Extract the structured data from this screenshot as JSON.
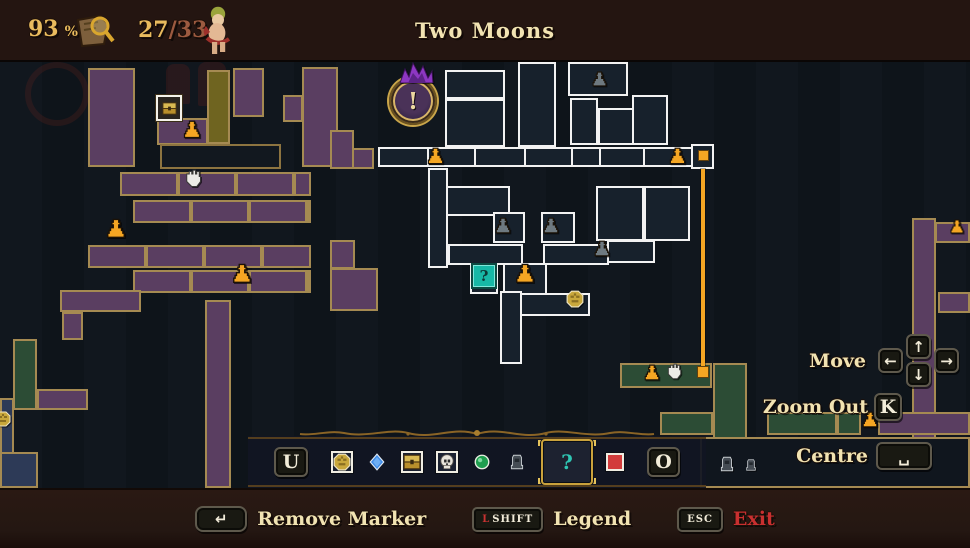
{
  "header": {
    "completion_value": "93",
    "completion_unit": "%",
    "collect_current": "27",
    "collect_rest": "/33",
    "title": "Two Moons"
  },
  "controls": {
    "move": {
      "label": "Move",
      "keys": {
        "left": "←",
        "up": "↑",
        "down": "↓",
        "right": "→"
      }
    },
    "zoom_out": {
      "label": "Zoom Out",
      "key": "K"
    },
    "centre": {
      "label": "Centre",
      "key_glyph": "␣"
    }
  },
  "marker_bar": {
    "left_key": "U",
    "right_key": "O",
    "selected_index": 6,
    "markers": [
      {
        "name": "gold-seal"
      },
      {
        "name": "blue-diamond"
      },
      {
        "name": "chest"
      },
      {
        "name": "skull"
      },
      {
        "name": "green-gem"
      },
      {
        "name": "tombstone"
      },
      {
        "name": "question-mark",
        "glyph": "?"
      },
      {
        "name": "red-square"
      }
    ]
  },
  "footer": {
    "remove_marker_key_glyph": "↵",
    "remove_marker_label": "Remove Marker",
    "legend_key_prefix": "L",
    "legend_key_text": "SHIFT",
    "legend_label": "Legend",
    "exit_key": "ESC",
    "exit_label": "Exit"
  },
  "map": {
    "player_marker": {
      "x": 389,
      "y": 17,
      "size": 44,
      "glyph": "!"
    },
    "question_marker_glyph": "?",
    "elevator": {
      "x": 701,
      "y": 109,
      "h": 199
    },
    "rooms": [
      [
        88,
        8,
        47,
        99,
        "P"
      ],
      [
        157,
        58,
        51,
        27,
        "P"
      ],
      [
        233,
        8,
        31,
        49,
        "P"
      ],
      [
        302,
        7,
        36,
        100,
        "P"
      ],
      [
        283,
        35,
        20,
        27,
        "P"
      ],
      [
        352,
        88,
        22,
        21,
        "P"
      ],
      [
        330,
        70,
        24,
        39,
        "P"
      ],
      [
        120,
        112,
        191,
        24,
        "P",
        "seg"
      ],
      [
        133,
        140,
        178,
        23,
        "P",
        "seg"
      ],
      [
        88,
        185,
        223,
        23,
        "P",
        "seg"
      ],
      [
        133,
        210,
        178,
        23,
        "P",
        "seg"
      ],
      [
        60,
        230,
        81,
        22,
        "P"
      ],
      [
        62,
        252,
        21,
        28,
        "P"
      ],
      [
        330,
        180,
        25,
        29,
        "P"
      ],
      [
        330,
        208,
        48,
        43,
        "P"
      ],
      [
        37,
        329,
        51,
        21,
        "P"
      ],
      [
        205,
        240,
        26,
        188,
        "P"
      ],
      [
        912,
        158,
        24,
        240,
        "P"
      ],
      [
        935,
        162,
        35,
        21,
        "P"
      ],
      [
        938,
        232,
        32,
        21,
        "P"
      ],
      [
        878,
        352,
        92,
        23,
        "P"
      ],
      [
        207,
        10,
        23,
        74,
        "O"
      ],
      [
        160,
        84,
        121,
        25,
        "D"
      ],
      [
        743,
        397,
        20,
        26,
        "D"
      ],
      [
        0,
        338,
        14,
        58,
        "N"
      ],
      [
        0,
        392,
        38,
        36,
        "N"
      ],
      [
        13,
        279,
        24,
        71,
        "G"
      ],
      [
        620,
        303,
        92,
        25,
        "G"
      ],
      [
        713,
        303,
        34,
        125,
        "G"
      ],
      [
        660,
        352,
        53,
        23,
        "G"
      ],
      [
        767,
        352,
        70,
        23,
        "G"
      ],
      [
        837,
        352,
        24,
        23,
        "G"
      ],
      [
        700,
        377,
        270,
        51,
        "X"
      ],
      [
        445,
        10,
        60,
        29,
        "W"
      ],
      [
        445,
        39,
        60,
        48,
        "W"
      ],
      [
        518,
        2,
        38,
        85,
        "W"
      ],
      [
        568,
        2,
        60,
        34,
        "W"
      ],
      [
        570,
        38,
        28,
        47,
        "W"
      ],
      [
        598,
        48,
        64,
        37,
        "W"
      ],
      [
        632,
        35,
        36,
        50,
        "W"
      ],
      [
        378,
        87,
        51,
        20,
        "W"
      ],
      [
        427,
        87,
        49,
        20,
        "W"
      ],
      [
        474,
        87,
        52,
        20,
        "W"
      ],
      [
        524,
        87,
        49,
        20,
        "W"
      ],
      [
        571,
        87,
        30,
        20,
        "W"
      ],
      [
        599,
        87,
        46,
        20,
        "W"
      ],
      [
        643,
        87,
        50,
        20,
        "W"
      ],
      [
        691,
        84,
        23,
        25,
        "W"
      ],
      [
        428,
        108,
        20,
        100,
        "W"
      ],
      [
        446,
        126,
        64,
        30,
        "W"
      ],
      [
        596,
        126,
        48,
        55,
        "W"
      ],
      [
        644,
        126,
        46,
        55,
        "W"
      ],
      [
        493,
        152,
        32,
        31,
        "W"
      ],
      [
        541,
        152,
        34,
        31,
        "W"
      ],
      [
        448,
        184,
        75,
        21,
        "W"
      ],
      [
        543,
        184,
        66,
        21,
        "W"
      ],
      [
        607,
        180,
        48,
        23,
        "W"
      ],
      [
        470,
        204,
        28,
        30,
        "W"
      ],
      [
        503,
        203,
        44,
        33,
        "W"
      ],
      [
        500,
        231,
        22,
        73,
        "W"
      ],
      [
        520,
        233,
        70,
        23,
        "W"
      ]
    ],
    "icons": [
      [
        "altar-gold",
        182,
        60,
        20
      ],
      [
        "altar-gold",
        105,
        158,
        22
      ],
      [
        "altar-gold",
        231,
        203,
        22
      ],
      [
        "altar-gold",
        426,
        87,
        19
      ],
      [
        "altar-gold",
        668,
        87,
        19
      ],
      [
        "altar-gold",
        514,
        203,
        22
      ],
      [
        "altar-gold",
        643,
        304,
        18
      ],
      [
        "altar-gold",
        861,
        351,
        18
      ],
      [
        "altar-gold",
        949,
        159,
        16
      ],
      [
        "altar-gray",
        591,
        11,
        17
      ],
      [
        "altar-gray",
        494,
        157,
        18
      ],
      [
        "altar-gray",
        542,
        157,
        18
      ],
      [
        "altar-gray",
        593,
        180,
        18
      ],
      [
        "hand",
        183,
        109,
        20
      ],
      [
        "hand",
        665,
        303,
        18
      ],
      [
        "chest",
        156,
        35,
        22
      ],
      [
        "seal",
        566,
        230,
        18
      ],
      [
        "seal",
        -5,
        351,
        16
      ],
      [
        "qmark",
        471,
        203,
        22
      ],
      [
        "tomb",
        718,
        395,
        18
      ],
      [
        "tomb",
        744,
        398,
        14
      ],
      [
        "orsq",
        698,
        90,
        9
      ],
      [
        "orsq",
        697,
        306,
        10
      ]
    ],
    "decor": {
      "ring": [
        25,
        2,
        52
      ],
      "statues": [
        [
          166,
          4,
          24,
          40
        ],
        [
          198,
          2,
          28,
          44
        ],
        [
          236,
          8,
          22,
          34
        ]
      ]
    }
  }
}
